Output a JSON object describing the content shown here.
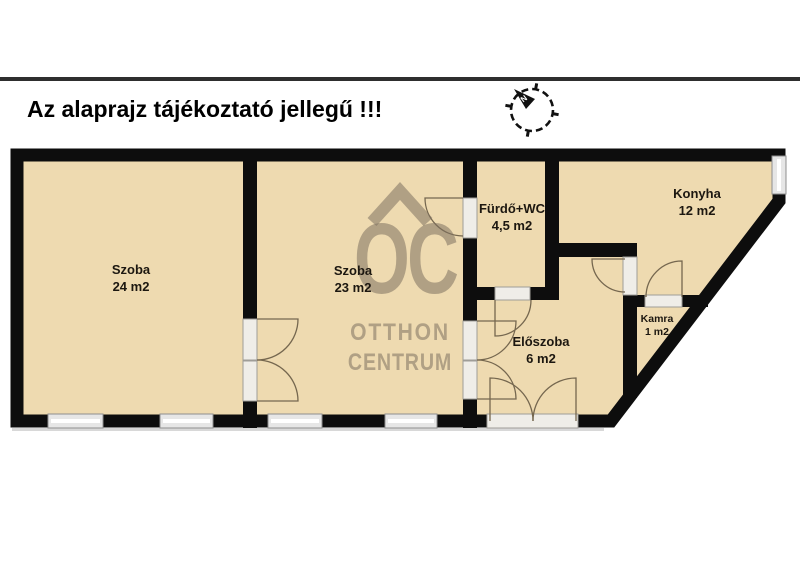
{
  "title": "Az alaprajz tájékoztató jellegű !!!",
  "compass": {
    "north_label": "N"
  },
  "watermark": {
    "line1": "OC",
    "line2": "OTTHON",
    "line3": "CENTRUM"
  },
  "rooms": [
    {
      "id": "szoba-24",
      "name": "Szoba",
      "area": "24 m2"
    },
    {
      "id": "szoba-23",
      "name": "Szoba",
      "area": "23 m2"
    },
    {
      "id": "furdo-wc",
      "name": "Fürdő+WC",
      "area": "4,5 m2"
    },
    {
      "id": "konyha",
      "name": "Konyha",
      "area": "12 m2"
    },
    {
      "id": "kamra",
      "name": "Kamra",
      "area": "1 m2"
    },
    {
      "id": "eloszoba",
      "name": "Előszoba",
      "area": "6 m2"
    }
  ],
  "theme": {
    "room_fill": "#eedab0",
    "wall_color": "#0d0d0d",
    "window_fill": "#e6e6e6",
    "window_frame": "#8f8f8f",
    "door_line": "#75674f",
    "watermark_color": "rgba(125,113,96,0.55)",
    "title_color": "#000000",
    "label_color": "#1c1710",
    "topline_color": "#2e2e2e"
  }
}
